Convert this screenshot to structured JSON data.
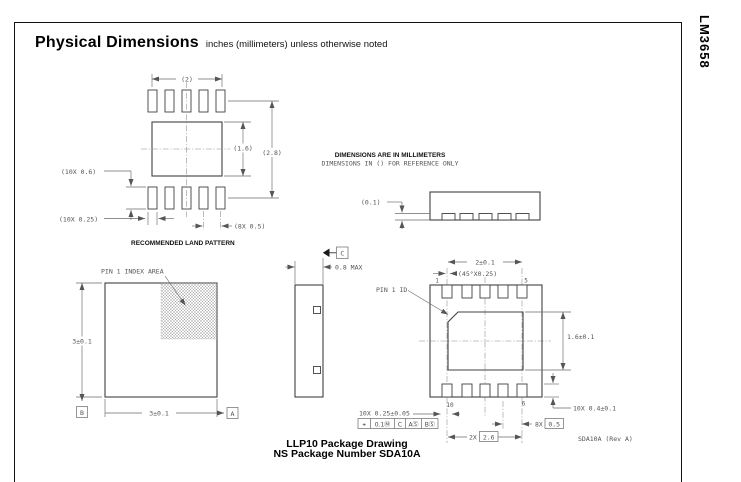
{
  "page": {
    "part_number": "LM3658",
    "title": "Physical Dimensions",
    "subtitle": "inches (millimeters) unless otherwise noted"
  },
  "notes": {
    "line1": "DIMENSIONS ARE IN MILLIMETERS",
    "line2": "DIMENSIONS IN () FOR REFERENCE ONLY"
  },
  "land_pattern": {
    "caption": "RECOMMENDED LAND PATTERN",
    "dim_width": "(2)",
    "dim_body_height": "(1.6)",
    "dim_overall_height": "(2.8)",
    "dim_pad_length": "(10X 0.6)",
    "dim_pad_width": "(10X 0.25)",
    "dim_pitch": "(8X 0.5)"
  },
  "top_side_view": {
    "dim_standoff": "(0.1)"
  },
  "top_view": {
    "pin1_label": "PIN 1 INDEX AREA",
    "dim_height": "3±0.1",
    "dim_width": "3±0.1",
    "datum_a": "A",
    "datum_b": "B"
  },
  "profile_view": {
    "dim_thickness": "0.8 MAX",
    "datum_c": "C"
  },
  "bottom_view": {
    "dim_pad_width": "2±0.1",
    "dim_chamfer": "(45°X0.25)",
    "pin1_label": "PIN 1 ID",
    "dim_pad_height": "1.6±0.1",
    "dim_lead_length": "10X 0.4±0.1",
    "dim_lead_width": "10X 0.25±0.05",
    "fcf": [
      "⌖",
      "0.1Ⓜ",
      "C",
      "AⓈ",
      "BⓈ"
    ],
    "pitch_qty": "8X",
    "pitch_value": "0.5",
    "span_qty": "2X",
    "span_value": "2.6",
    "pin_1": "1",
    "pin_5": "5",
    "pin_6": "6",
    "pin_10": "10",
    "rev_label": "SDA10A (Rev A)"
  },
  "footer": {
    "line1": "LLP10 Package Drawing",
    "line2": "NS Package Number SDA10A"
  }
}
